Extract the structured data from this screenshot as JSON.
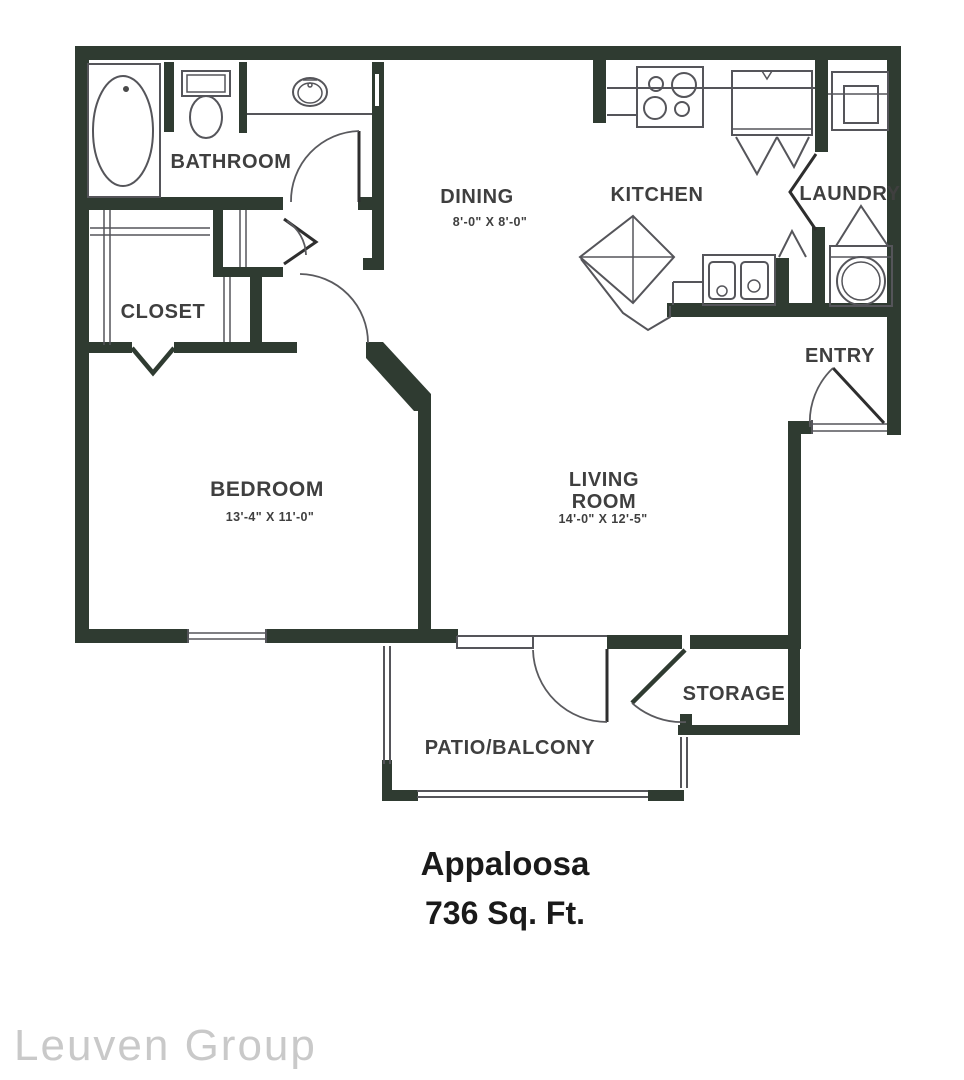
{
  "title": {
    "name": "Appaloosa",
    "area": "736 Sq. Ft."
  },
  "watermark": "Leuven Group",
  "rooms": {
    "bathroom": {
      "label": "BATHROOM"
    },
    "closet": {
      "label": "CLOSET"
    },
    "dining": {
      "label": "DINING",
      "dims": "8'-0\" X 8'-0\""
    },
    "kitchen": {
      "label": "KITCHEN"
    },
    "laundry": {
      "label": "LAUNDRY"
    },
    "entry": {
      "label": "ENTRY"
    },
    "bedroom": {
      "label": "BEDROOM",
      "dims": "13'-4\" X 11'-0\""
    },
    "living_room": {
      "label_line1": "LIVING",
      "label_line2": "ROOM",
      "dims": "14'-0\" X 12'-5\""
    },
    "storage": {
      "label": "STORAGE"
    },
    "patio": {
      "label": "PATIO/BALCONY"
    }
  },
  "colors": {
    "wall": "#2f3b31",
    "line": "#55555a",
    "label_text": "#3f3f3f",
    "title_text": "#1a1a1a",
    "watermark_text": "#c9c9c9",
    "background": "#ffffff"
  }
}
